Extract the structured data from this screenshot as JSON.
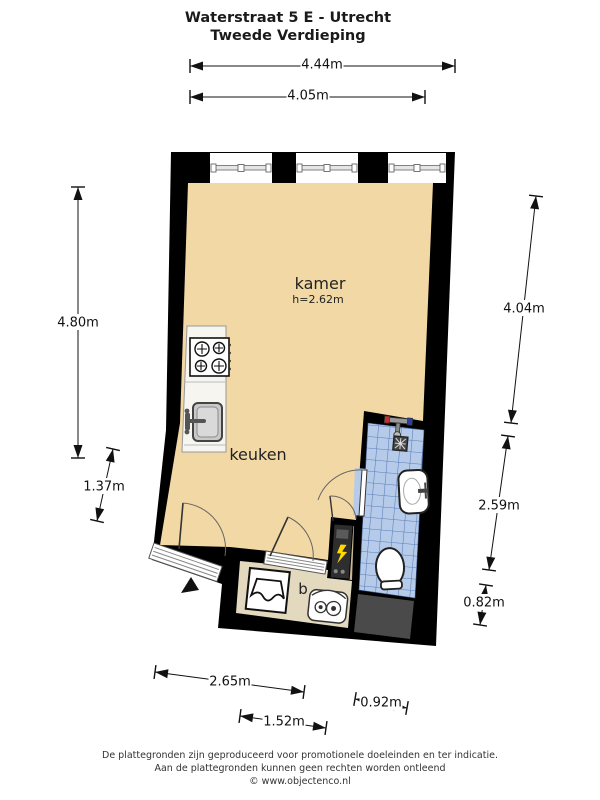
{
  "title": {
    "line1": "Waterstraat 5 E - Utrecht",
    "line2": "Tweede Verdieping"
  },
  "rooms": {
    "kamer_label": "kamer",
    "kamer_height": "h=2.62m",
    "keuken_label": "keuken",
    "b_label": "b"
  },
  "icons": {
    "stove": "stove-icon",
    "sink": "sink-icon",
    "shower": "shower-mixer-icon",
    "drain": "drain-icon",
    "washbasin": "washbasin-icon",
    "toilet": "toilet-icon",
    "washer": "washer-icon",
    "boiler": "boiler-icon",
    "meter": "meter-cabinet-icon",
    "north_arrow": "north-arrow-icon"
  },
  "colors": {
    "wall": "#000000",
    "floor": "#f2d8a5",
    "tile": "#b5cbe9",
    "tile_grid": "#5b7cb8",
    "b_floor": "#e3d9bf",
    "closet_floor": "#c9b795",
    "void": "#4a4a4a",
    "accent_hot": "#c23030",
    "accent_cold": "#2f3f9e",
    "meter_warning": "#ffd900"
  },
  "dimensions": [
    {
      "label": "4.44m",
      "x1": 190,
      "y1": 66,
      "x2": 455,
      "y2": 66,
      "lx": 322,
      "ly": 64
    },
    {
      "label": "4.05m",
      "x1": 190,
      "y1": 97,
      "x2": 425,
      "y2": 97,
      "lx": 308,
      "ly": 95
    },
    {
      "label": "4.80m",
      "x1": 78,
      "y1": 187,
      "x2": 78,
      "y2": 458,
      "lx": 78,
      "ly": 322
    },
    {
      "label": "1.37m",
      "x1": 113,
      "y1": 449,
      "x2": 97,
      "y2": 521,
      "lx": 104,
      "ly": 486
    },
    {
      "label": "4.04m",
      "x1": 536,
      "y1": 196,
      "x2": 511,
      "y2": 423,
      "lx": 524,
      "ly": 308
    },
    {
      "label": "2.59m",
      "x1": 508,
      "y1": 436,
      "x2": 489,
      "y2": 570,
      "lx": 499,
      "ly": 505
    },
    {
      "label": "0.82m",
      "x1": 486,
      "y1": 585,
      "x2": 480,
      "y2": 625,
      "lx": 484,
      "ly": 602
    },
    {
      "label": "2.65m",
      "x1": 155,
      "y1": 672,
      "x2": 304,
      "y2": 692,
      "lx": 230,
      "ly": 681
    },
    {
      "label": "1.52m",
      "x1": 240,
      "y1": 716,
      "x2": 326,
      "y2": 728,
      "lx": 284,
      "ly": 721
    },
    {
      "label": "0.92m",
      "x1": 355,
      "y1": 699,
      "x2": 407,
      "y2": 708,
      "lx": 381,
      "ly": 702
    }
  ],
  "footer": {
    "line1": "De plattegronden zijn geproduceerd voor promotionele doeleinden en ter indicatie.",
    "line2": "Aan de plattegronden kunnen geen rechten worden ontleend",
    "line3": "© www.objectenco.nl"
  }
}
